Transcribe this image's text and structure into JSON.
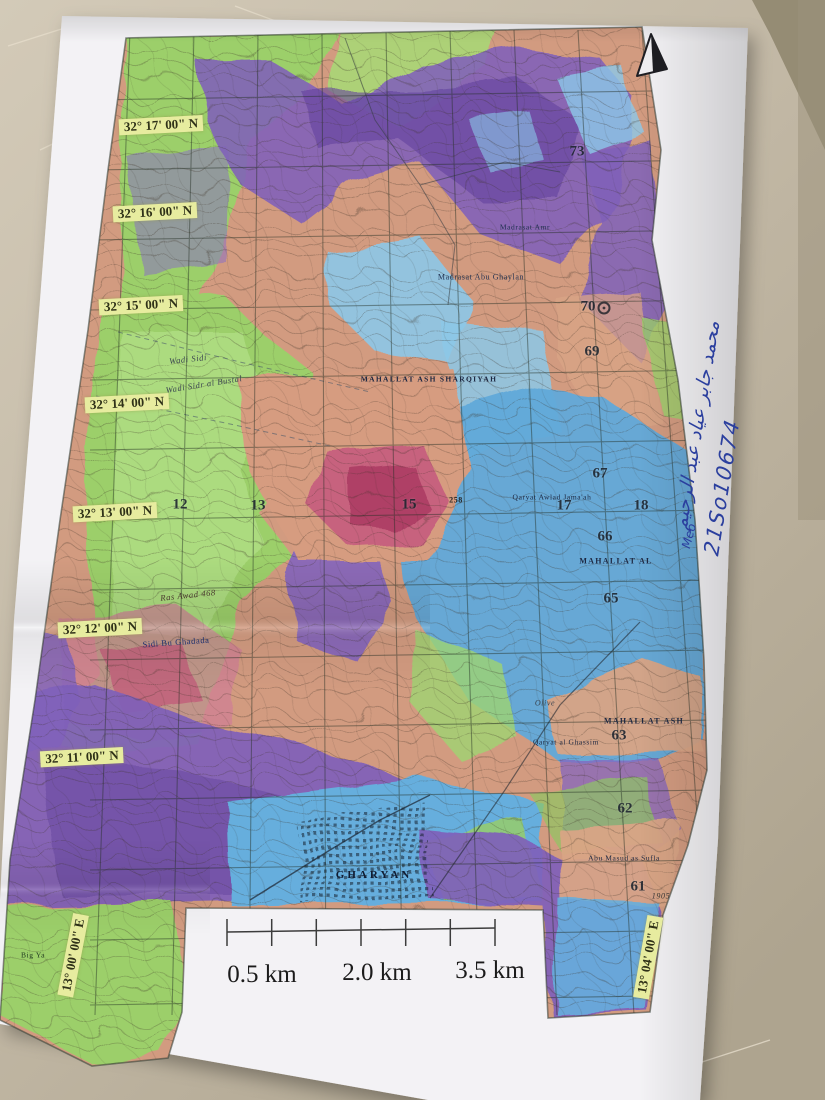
{
  "scene": {
    "description": "Photograph of a hand-coloured topographic map sheet of the Gharyan area lying on a tan surface",
    "surface_color": "#c7bdab",
    "paper_color": "#f3f2f5",
    "highlight_color": "#e7ec9f",
    "ink_color": "#2b3f9e"
  },
  "coordinates": {
    "lat_labels": [
      {
        "text": "32° 17' 00\" N"
      },
      {
        "text": "32° 16' 00\" N"
      },
      {
        "text": "32° 15' 00\" N"
      },
      {
        "text": "32° 14' 00\" N"
      },
      {
        "text": "32° 13' 00\" N"
      },
      {
        "text": "32° 12' 00\" N"
      },
      {
        "text": "32° 11' 00\" N"
      }
    ],
    "lon_labels": [
      {
        "text": "13° 00' 00\" E"
      },
      {
        "text": "13° 04' 00\" E"
      }
    ]
  },
  "grid_numbers": [
    "73",
    "70",
    "69",
    "12",
    "13",
    "15",
    "17",
    "18",
    "67",
    "66",
    "65",
    "63",
    "62",
    "61"
  ],
  "place_labels": [
    {
      "text": "GHARYAN"
    },
    {
      "text": "MAHALLAT ASH SHARQIYAH"
    },
    {
      "text": "MAHALLAT AL"
    },
    {
      "text": "MAHALLAT ASH"
    },
    {
      "text": "Madrasat Abu Ghaylan"
    },
    {
      "text": "Madrasat Amr"
    },
    {
      "text": "Wadi Sidi"
    },
    {
      "text": "Wadi Sidr al Bustal"
    },
    {
      "text": "Ras Awad 468"
    },
    {
      "text": "Sidi Bu Ghadada"
    },
    {
      "text": "Qaryat Awlad Jama'ah"
    },
    {
      "text": "Qaryat al Ghassim"
    },
    {
      "text": "Abu Masud as Sufla"
    },
    {
      "text": "Olive"
    },
    {
      "text": "Big Ya"
    },
    {
      "text": "1905"
    },
    {
      "text": "258"
    }
  ],
  "scale_bar": {
    "labels": [
      "0.5 km",
      "2.0 km",
      "3.5 km"
    ]
  },
  "handwriting": {
    "line1": "محمد جابر عياد عبد الرحيم",
    "line2": "21So10674",
    "note": "Meo"
  }
}
